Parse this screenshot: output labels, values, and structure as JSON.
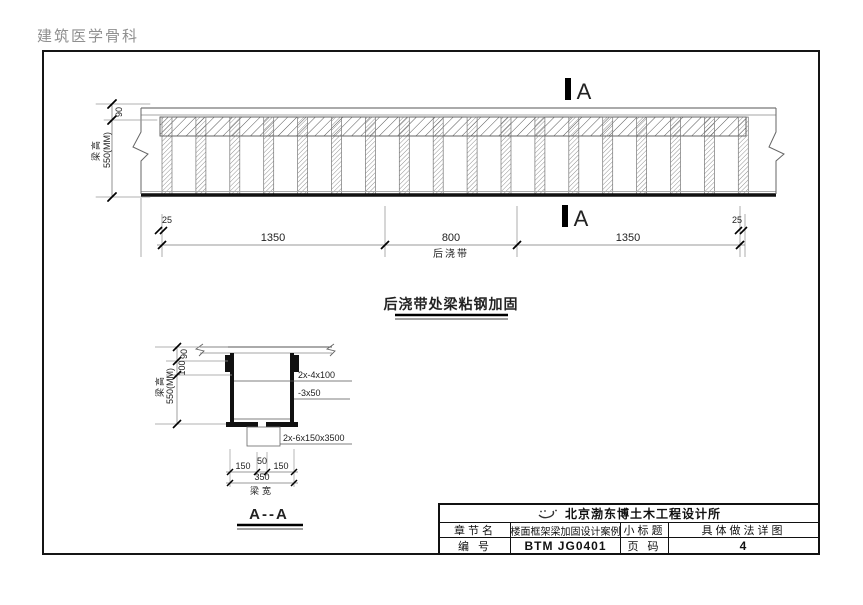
{
  "watermark": "建筑医学骨科",
  "colors": {
    "line": "#333333",
    "accent": "#000000",
    "gray_text": "#8f8f8f"
  },
  "elevation": {
    "section_mark": "A",
    "dims": {
      "top": "90",
      "beam_height_label": "梁高",
      "beam_height_value": "550(MM)",
      "left_end": "25",
      "span1": "1350",
      "span2": "800",
      "span3": "1350",
      "right_end": "25"
    },
    "post_cast_label": "后浇带",
    "title": "后浇带处梁粘钢加固"
  },
  "section": {
    "title": "A--A",
    "dims": {
      "top": "90",
      "second": "100",
      "beam_height_label": "梁高",
      "beam_height_value": "550(MM)",
      "bottom_left": "150",
      "bottom_mid": "50",
      "bottom_right": "150",
      "bottom_total": "350",
      "beam_width_label": "梁宽"
    },
    "labels": {
      "angle_plate": "2x-4x100",
      "side_plate": "-3x50",
      "bottom_plate": "2x-6x150x3500"
    }
  },
  "title_block": {
    "company": "北京渤东博土木工程设计所",
    "chapter_label": "章节名",
    "chapter_value": "楼面框架梁加固设计案例",
    "subtitle_label": "小标题",
    "subtitle_value": "具体做法详图",
    "number_label": "编 号",
    "number_value": "BTM JG0401",
    "page_label": "页 码",
    "page_value": "4"
  }
}
